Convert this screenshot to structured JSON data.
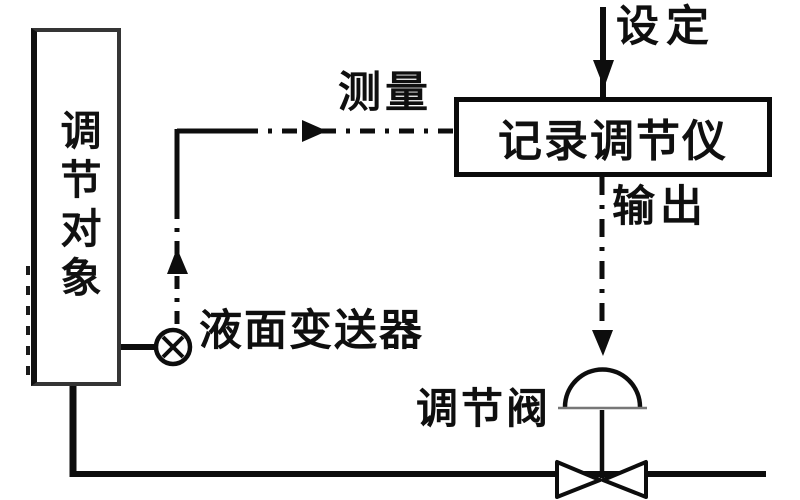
{
  "diagram": {
    "type": "control-loop-block-diagram",
    "labels": {
      "controlled_object": "调节对象",
      "setpoint": "设定",
      "measurement": "测量",
      "controller": "记录调节仪",
      "output": "输出",
      "transmitter": "液面变送器",
      "control_valve": "调节阀"
    },
    "symbols": {
      "transmitter_symbol": "circle-with-x",
      "valve_symbol": "dome-actuator-with-bowtie-body",
      "signal_line_style": "dash-dot",
      "pipe_line_style": "solid"
    },
    "colors": {
      "ink": "#0d0d0d",
      "box_border": "#353535",
      "background": "#ffffff"
    }
  }
}
